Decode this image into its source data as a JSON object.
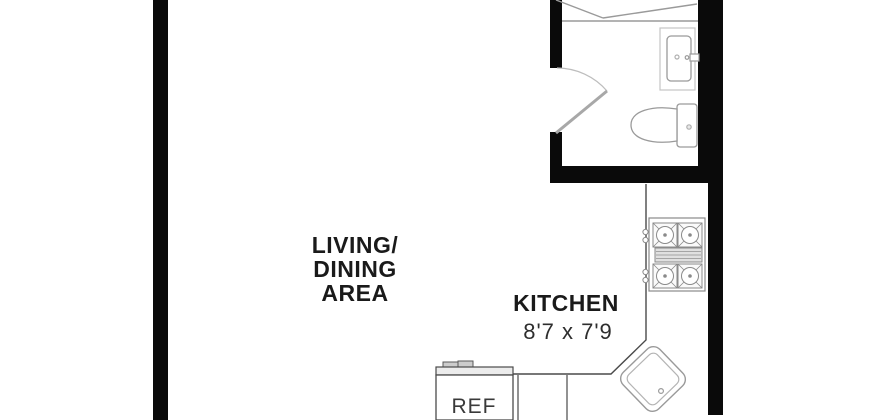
{
  "plan": {
    "type": "apartment-floor-plan",
    "colors": {
      "wall": "#0a0a0a",
      "fixture_line": "#9a9a9a",
      "counter_line": "#4a4a4a",
      "label_text": "#1a1a1a",
      "background": "#ffffff"
    },
    "labels": {
      "living_dining": {
        "line1": "LIVING/",
        "line2": "DINING",
        "line3": "AREA"
      },
      "kitchen": {
        "name": "KITCHEN",
        "dimensions": "8'7 x 7'9"
      },
      "refrigerator": "REF"
    },
    "fixtures": {
      "bathroom": [
        "closet",
        "door-swing",
        "vanity-sink",
        "toilet"
      ],
      "kitchen": [
        "counter",
        "range-stove",
        "kitchen-sink",
        "refrigerator",
        "base-cabinets"
      ]
    }
  }
}
